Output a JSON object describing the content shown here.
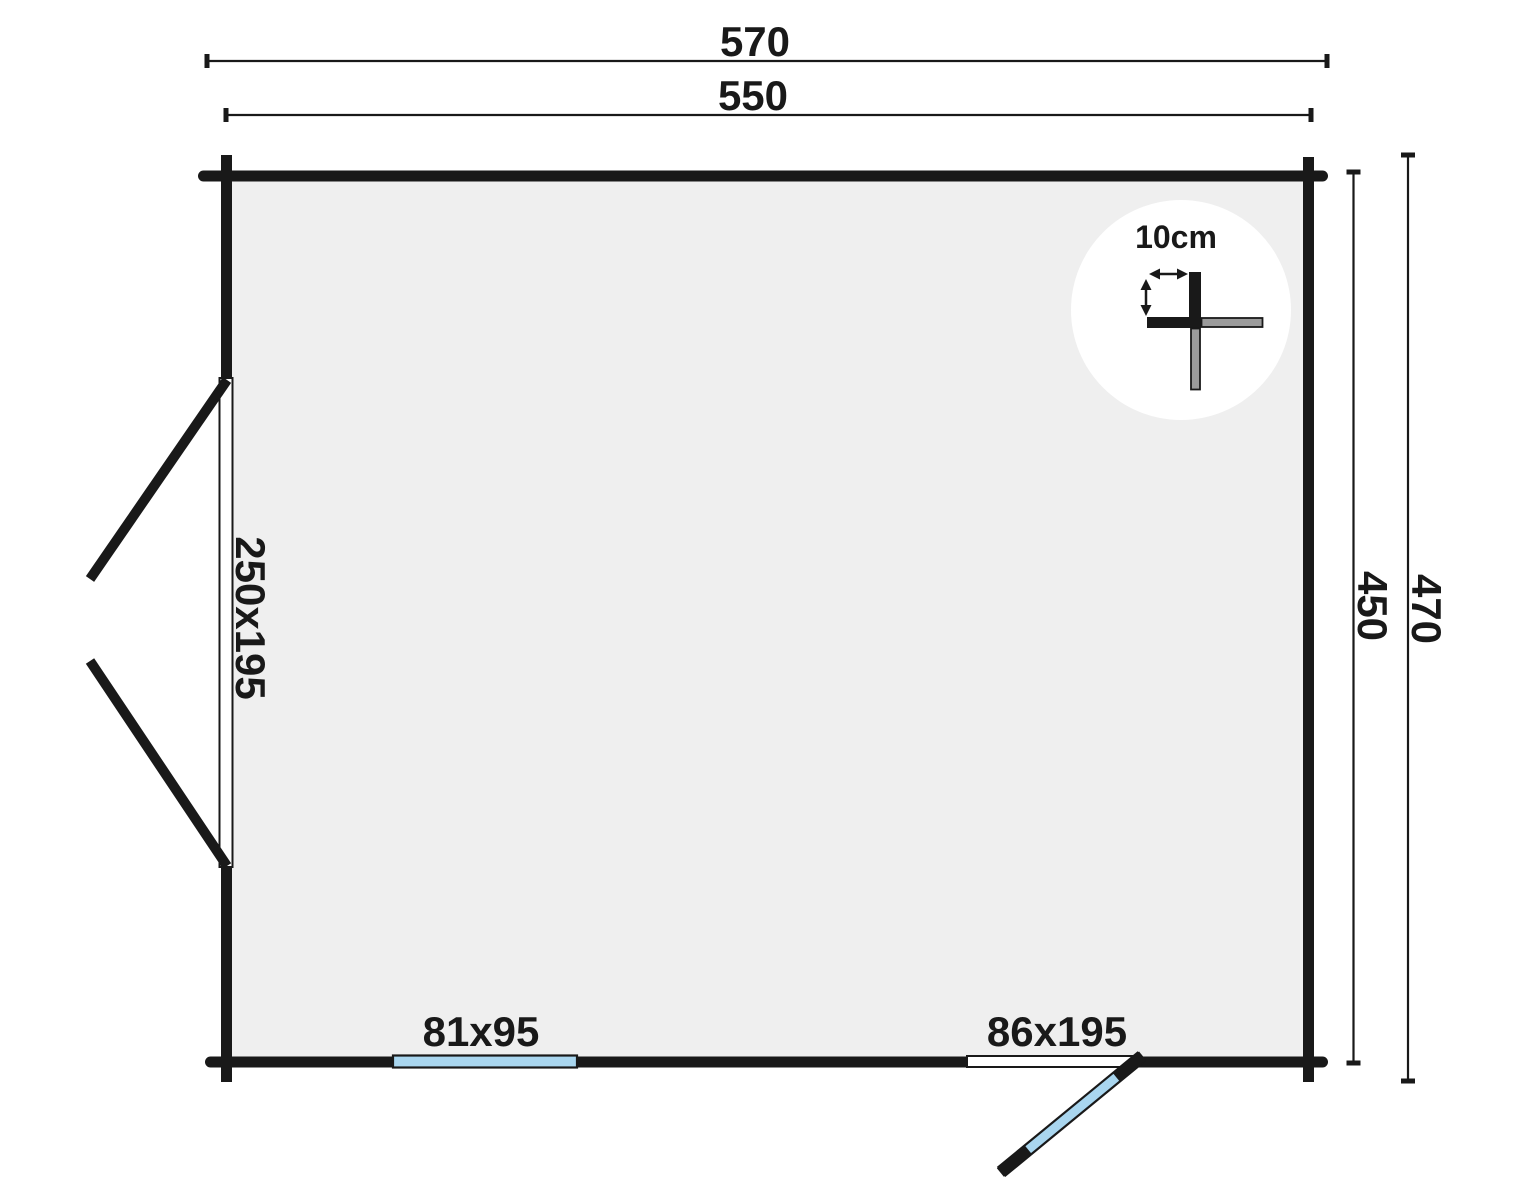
{
  "figure": {
    "type": "floor-plan",
    "description": "Garden log cabin floor plan with dimension lines and wall-thickness detail"
  },
  "colors": {
    "wall": "#191919",
    "room_fill": "#efefef",
    "glass": "#a9d6ef",
    "detail_gray": "#9b9b9b",
    "paper": "#ffffff",
    "detail_circle": "#ffffff"
  },
  "dimensions": {
    "outer_width": "570",
    "inner_width": "550",
    "inner_depth": "450",
    "outer_depth": "470"
  },
  "openings": {
    "double_door_label": "250x195",
    "window_label": "81x95",
    "single_door_label": "86x195"
  },
  "detail": {
    "wall_thickness_label": "10cm"
  }
}
